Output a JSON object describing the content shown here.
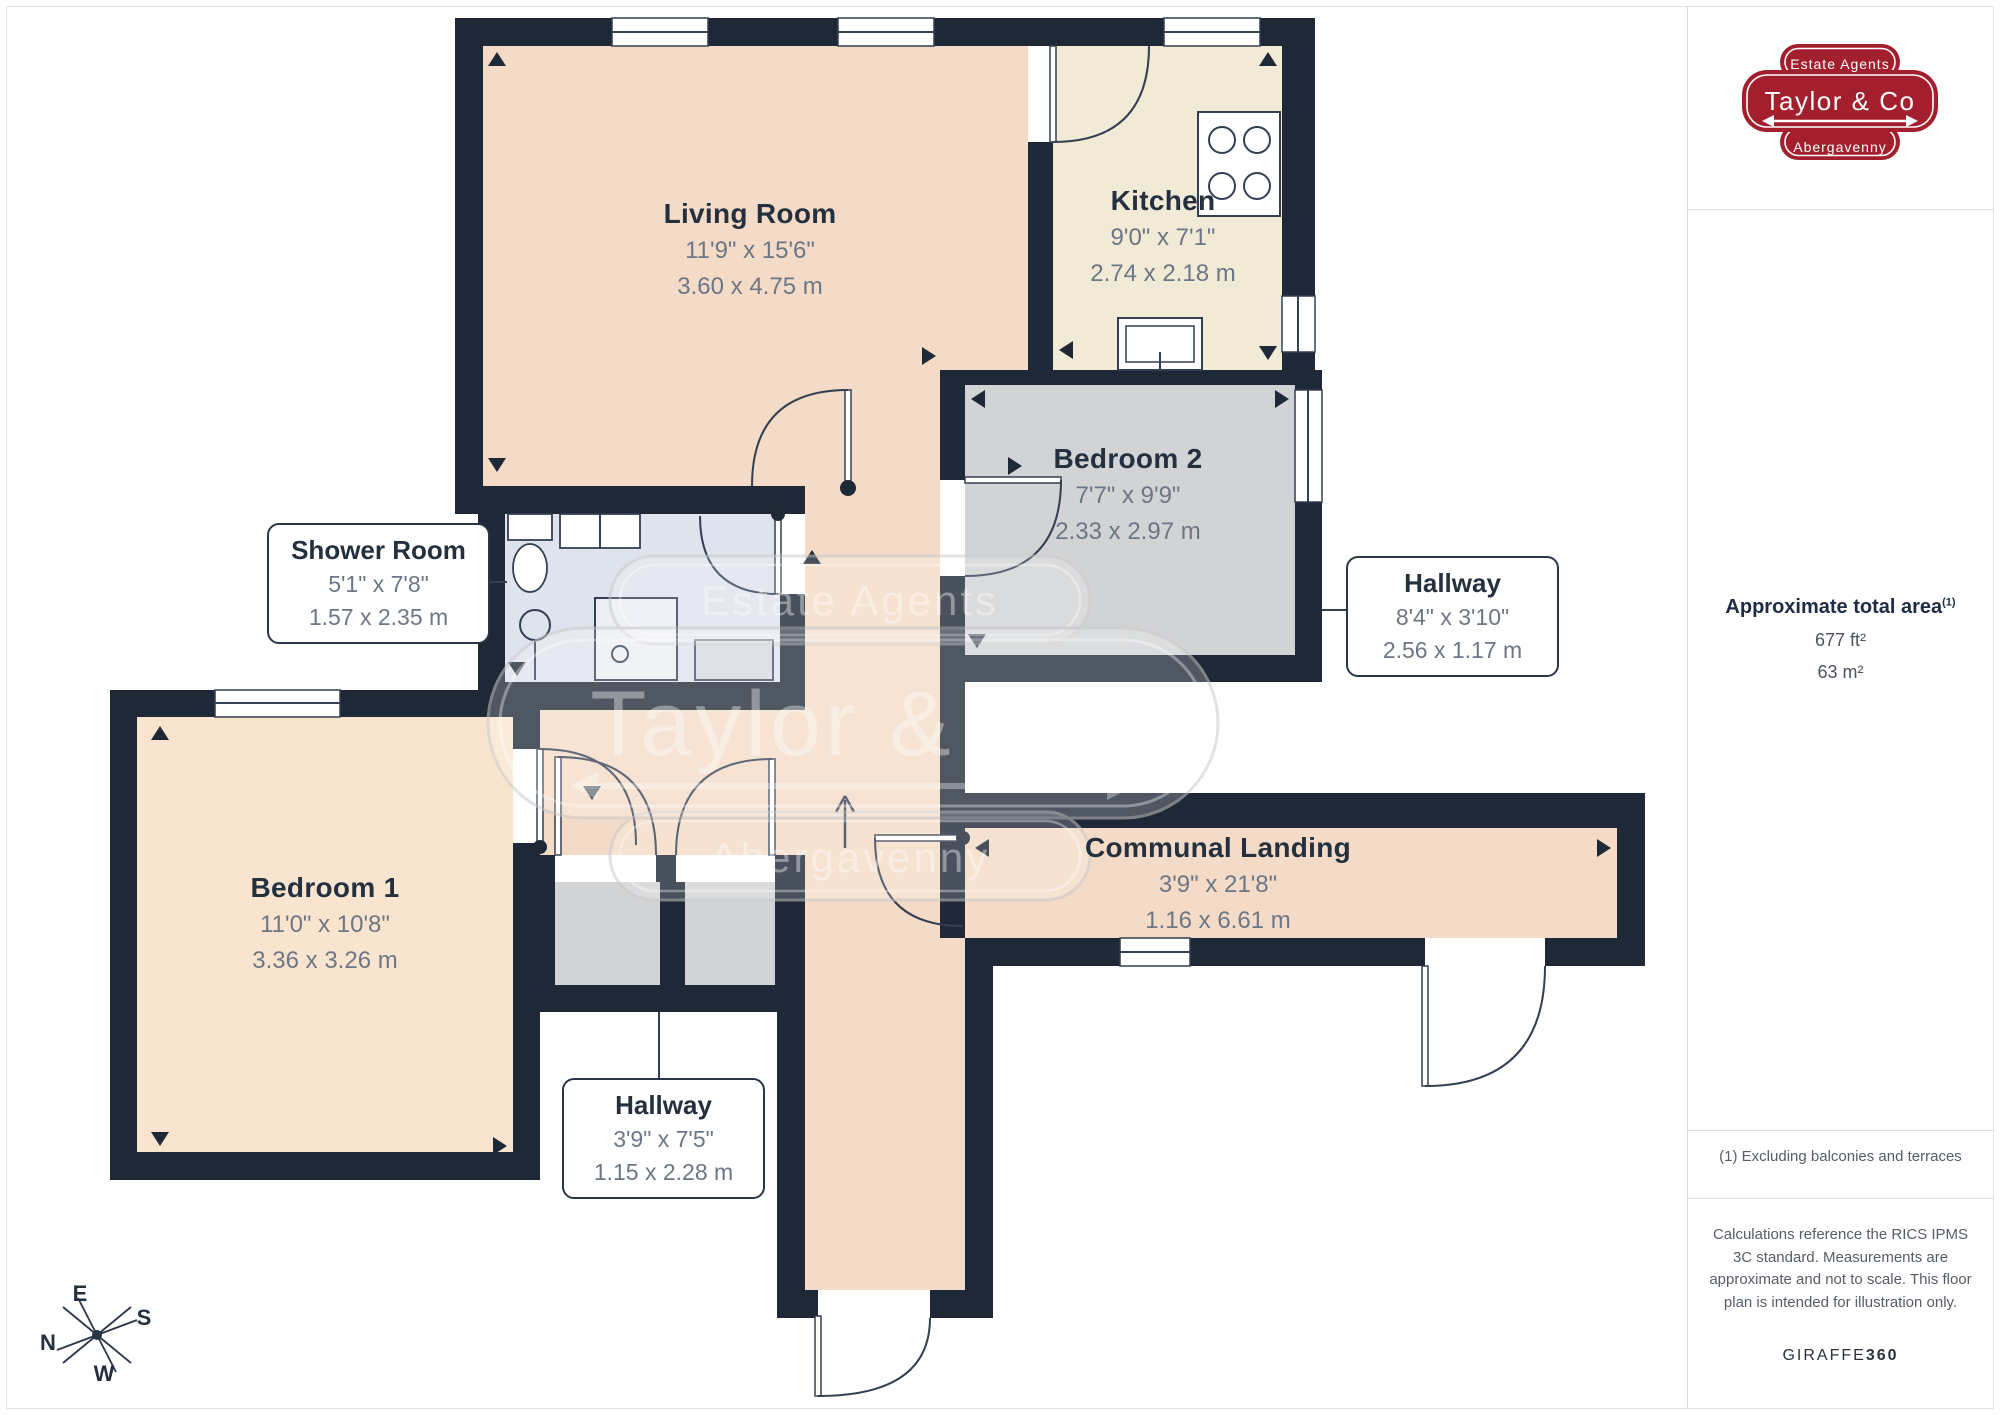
{
  "branding": {
    "badge": {
      "top": "Estate Agents",
      "name": "Taylor & Co",
      "bottom": "Abergavenny"
    }
  },
  "panel": {
    "area_title": "Approximate total area",
    "area_superscript": "(1)",
    "area_ft": "677 ft²",
    "area_m": "63 m²",
    "footnote": "(1) Excluding balconies and terraces",
    "disclaimer": "Calculations reference the RICS IPMS 3C standard. Measurements are approximate and not to scale. This floor plan is intended for illustration only.",
    "credit_regular": "GIRAFFE",
    "credit_bold": "360"
  },
  "compass": {
    "n": "N",
    "e": "E",
    "s": "S",
    "w": "W"
  },
  "rooms": [
    {
      "name": "Living Room",
      "imperial": "11'9\" x 15'6\"",
      "metric": "3.60 x 4.75 m"
    },
    {
      "name": "Kitchen",
      "imperial": "9'0\" x 7'1\"",
      "metric": "2.74 x 2.18 m"
    },
    {
      "name": "Bedroom 2",
      "imperial": "7'7\" x 9'9\"",
      "metric": "2.33 x 2.97 m"
    },
    {
      "name": "Shower Room",
      "imperial": "5'1\" x 7'8\"",
      "metric": "1.57 x 2.35 m"
    },
    {
      "name": "Hallway",
      "imperial": "8'4\" x 3'10\"",
      "metric": "2.56 x 1.17 m"
    },
    {
      "name": "Bedroom 1",
      "imperial": "11'0\" x 10'8\"",
      "metric": "3.36 x 3.26 m"
    },
    {
      "name": "Communal Landing",
      "imperial": "3'9\" x 21'8\"",
      "metric": "1.16 x 6.61 m"
    },
    {
      "name": "Hallway",
      "imperial": "3'9\" x 7'5\"",
      "metric": "1.15 x 2.28 m"
    }
  ],
  "colors": {
    "wall": "#1e2836",
    "living_peach": "#f3dbc7",
    "kitchen_cream": "#f1ead6",
    "bedroom_grey": "#d2d3d5",
    "shower_lavender": "#dfe3ee",
    "bedroom1_cream": "#f9e5cf",
    "brand_red": "#a31f2e"
  }
}
